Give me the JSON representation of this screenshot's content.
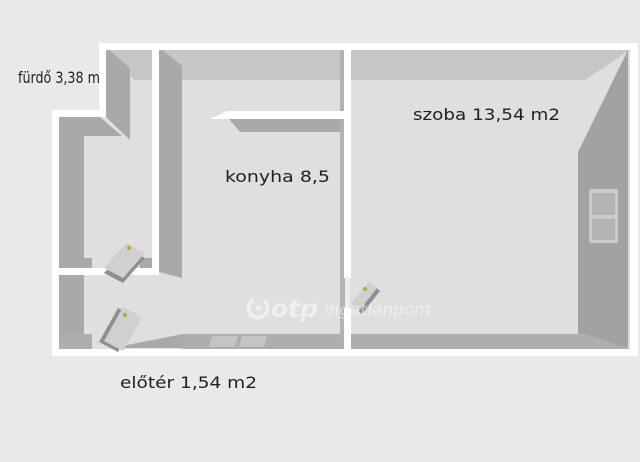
{
  "plan": {
    "type": "floor-plan",
    "rooms": [
      {
        "id": "furdo",
        "label": "fürdő 3,38 m2"
      },
      {
        "id": "szoba",
        "label": "szoba 13,54 m2"
      },
      {
        "id": "konyha",
        "label": "konyha 8,5"
      },
      {
        "id": "eloter",
        "label": "előtér 1,54 m2"
      }
    ],
    "features": {
      "doors": [
        "furdo-door",
        "entrance-door",
        "szoba-door"
      ],
      "windows": [
        "right-wall-window",
        "bottom-wall-window"
      ]
    }
  },
  "watermark": {
    "brand": "otp",
    "suffix": "ingatlanpont"
  },
  "colors": {
    "background": "#e9e9e9",
    "floor": "#dfdfdf",
    "wall_top": "#ffffff",
    "wall_face": "#a9a9a9",
    "wall_face_dark": "#a2a2a2",
    "top_band": "#c6c6c6",
    "bottom_band": "#aeaeae",
    "window_frame": "#c9c9c9",
    "window_pane": "#b3b3b3",
    "door_leaf": "#d0d0d0",
    "door_edge": "#8f8f8f",
    "door_handle": "#b3ae3c",
    "label": "#1f1f1f",
    "watermark": "#ffffff"
  }
}
